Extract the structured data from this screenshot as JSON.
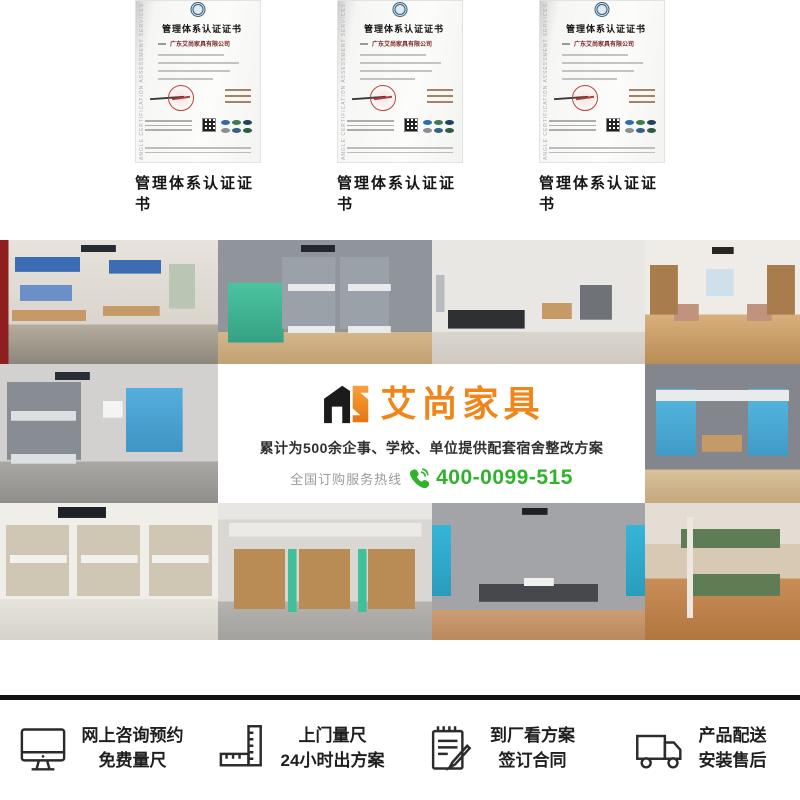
{
  "brand": {
    "logo_text": "艾尚家具",
    "logo_mark": "AS",
    "accent_orange": "#F08519",
    "accent_green": "#2FB32B"
  },
  "certificates": {
    "items": [
      {
        "title": "管理体系认证证书",
        "company": "广东艾尚家具有限公司",
        "side_text": "ANGLE CERTIFICATION ASSESSMENT SERVICES",
        "caption": "管理体系认证证书"
      },
      {
        "title": "管理体系认证证书",
        "company": "广东艾尚家具有限公司",
        "side_text": "ANGLE CERTIFICATION ASSESSMENT SERVICES",
        "caption": "管理体系认证证书"
      },
      {
        "title": "管理体系认证证书",
        "company": "广东艾尚家具有限公司",
        "side_text": "ANGLE CERTIFICATION ASSESSMENT SERVICES",
        "caption": "管理体系认证证书"
      }
    ]
  },
  "banner": {
    "slogan": "累计为500余企事、学校、单位提供配套宿舍整改方案",
    "hotline_label": "全国订购服务热线",
    "hotline_number": "400-0099-515"
  },
  "gallery": {
    "items": [
      {
        "alt": "dorm room with blue bunk beds and desks, red wall edge"
      },
      {
        "alt": "room with green lockers and gray bunk beds"
      },
      {
        "alt": "minimal room with single dark bed, desk and gray cabinet"
      },
      {
        "alt": "narrow room with wooden wardrobes and window"
      },
      {
        "alt": "dorm with gray bunk beds and light blue lockers"
      },
      {
        "alt": "blue bunk-desk combination unit against gray wall"
      },
      {
        "alt": "white bunk beds on marble floor"
      },
      {
        "alt": "loft beds over wooden wardrobes and desks with teal ladders"
      },
      {
        "alt": "two metal slat beds between blue doors"
      },
      {
        "alt": "bunk beds with green boards on orange wood floor"
      }
    ]
  },
  "services": {
    "items": [
      {
        "icon": "monitor-icon",
        "line1": "网上咨询预约",
        "line2": "免费量尺"
      },
      {
        "icon": "ruler-icon",
        "line1": "上门量尺",
        "line2": "24小时出方案"
      },
      {
        "icon": "contract-icon",
        "line1": "到厂看方案",
        "line2": "签订合同"
      },
      {
        "icon": "truck-icon",
        "line1": "产品配送",
        "line2": "安装售后"
      }
    ]
  }
}
